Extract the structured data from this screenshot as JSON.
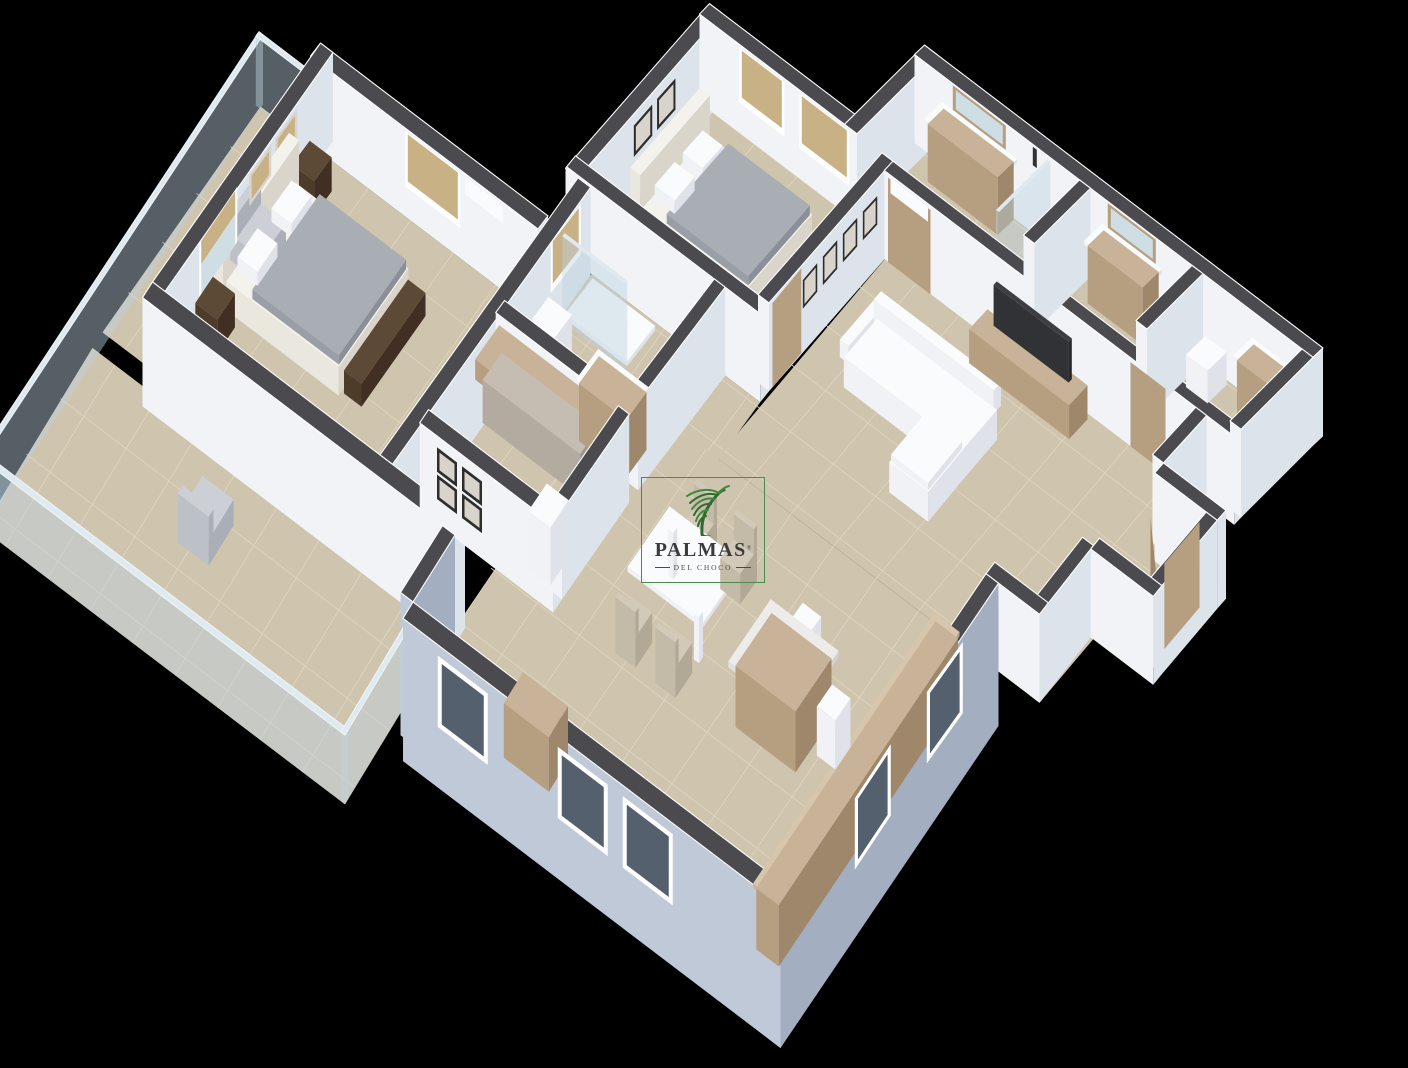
{
  "watermark": {
    "brand": "PALMAS",
    "registered": "®",
    "subtitle": "DEL CHOCO"
  },
  "palette": {
    "background": "#000000",
    "wallTop": "#4a4a4f",
    "wallLight": "#f1f3f7",
    "wallShade": "#dde3eb",
    "facadeLight": "#bfc9d8",
    "facadeShade": "#a3aec0",
    "floor": "#cfc4ad",
    "grout": "#e0d7c2",
    "wood": [
      "#c8b298",
      "#b69e81",
      "#9e876b"
    ],
    "woodlight": [
      "#d8c6ac",
      "#cab698",
      "#b2a082"
    ],
    "darkwood": [
      "#5c4936",
      "#4e3c2b",
      "#402f22"
    ],
    "cream": [
      "#f4f2ec",
      "#eae7df",
      "#d9d5cb"
    ],
    "white": [
      "#fafbfc",
      "#f0f2f5",
      "#dfe3e9"
    ],
    "duvet": [
      "#a9adb4",
      "#9a9ea6",
      "#8b8f98"
    ],
    "dark": [
      "#3c3e43",
      "#303236",
      "#26282c"
    ],
    "marble": [
      "#edecea",
      "#e1e0de",
      "#d3d2d0"
    ],
    "beige": [
      "#d2c9b9",
      "#c4baa8",
      "#b2a896"
    ],
    "chair": [
      "#ccd0d6",
      "#bcc0c7",
      "#aaaeb6"
    ],
    "cloth": [
      "#c5bdb2",
      "#b3aba0",
      "#a09890"
    ],
    "glass": "rgba(188,210,223,0.45)",
    "glassTop": "#dfe9f0",
    "tan": "#c8b184",
    "winFrame": "#ffffff",
    "winGlass": "#55606e",
    "frame": "#2e2d2b",
    "frameInner": "#d8d4cc",
    "mirror": "#cfdde4",
    "logoGreen": "#4c8a52",
    "leaf": "#3e8a3c",
    "leafDark": "#2e6b2d",
    "logoText": "#3b3b3d"
  },
  "scene": {
    "type": "3d-apartment-floor-plan-render",
    "rooms": [
      "master-bedroom",
      "bedroom-2",
      "bathroom-1",
      "bathroom-2",
      "bathroom-3",
      "walk-in-closet",
      "living-room",
      "dining-area",
      "kitchen",
      "entry-hall",
      "terrace"
    ],
    "furniture": [
      "double-bed",
      "headboard",
      "nightstand",
      "wardrobe-doors",
      "air-conditioner",
      "picture-frames",
      "roman-shade-window",
      "vanity-with-mirror",
      "glass-shower",
      "toilet",
      "washer",
      "hanging-clothes",
      "tv-console",
      "television",
      "l-shaped-sofa",
      "dining-table",
      "dining-chairs",
      "kitchen-island",
      "bar-stools",
      "kitchen-counter",
      "sideboard",
      "terrace-armchairs",
      "glass-railing",
      "entry-door"
    ]
  }
}
